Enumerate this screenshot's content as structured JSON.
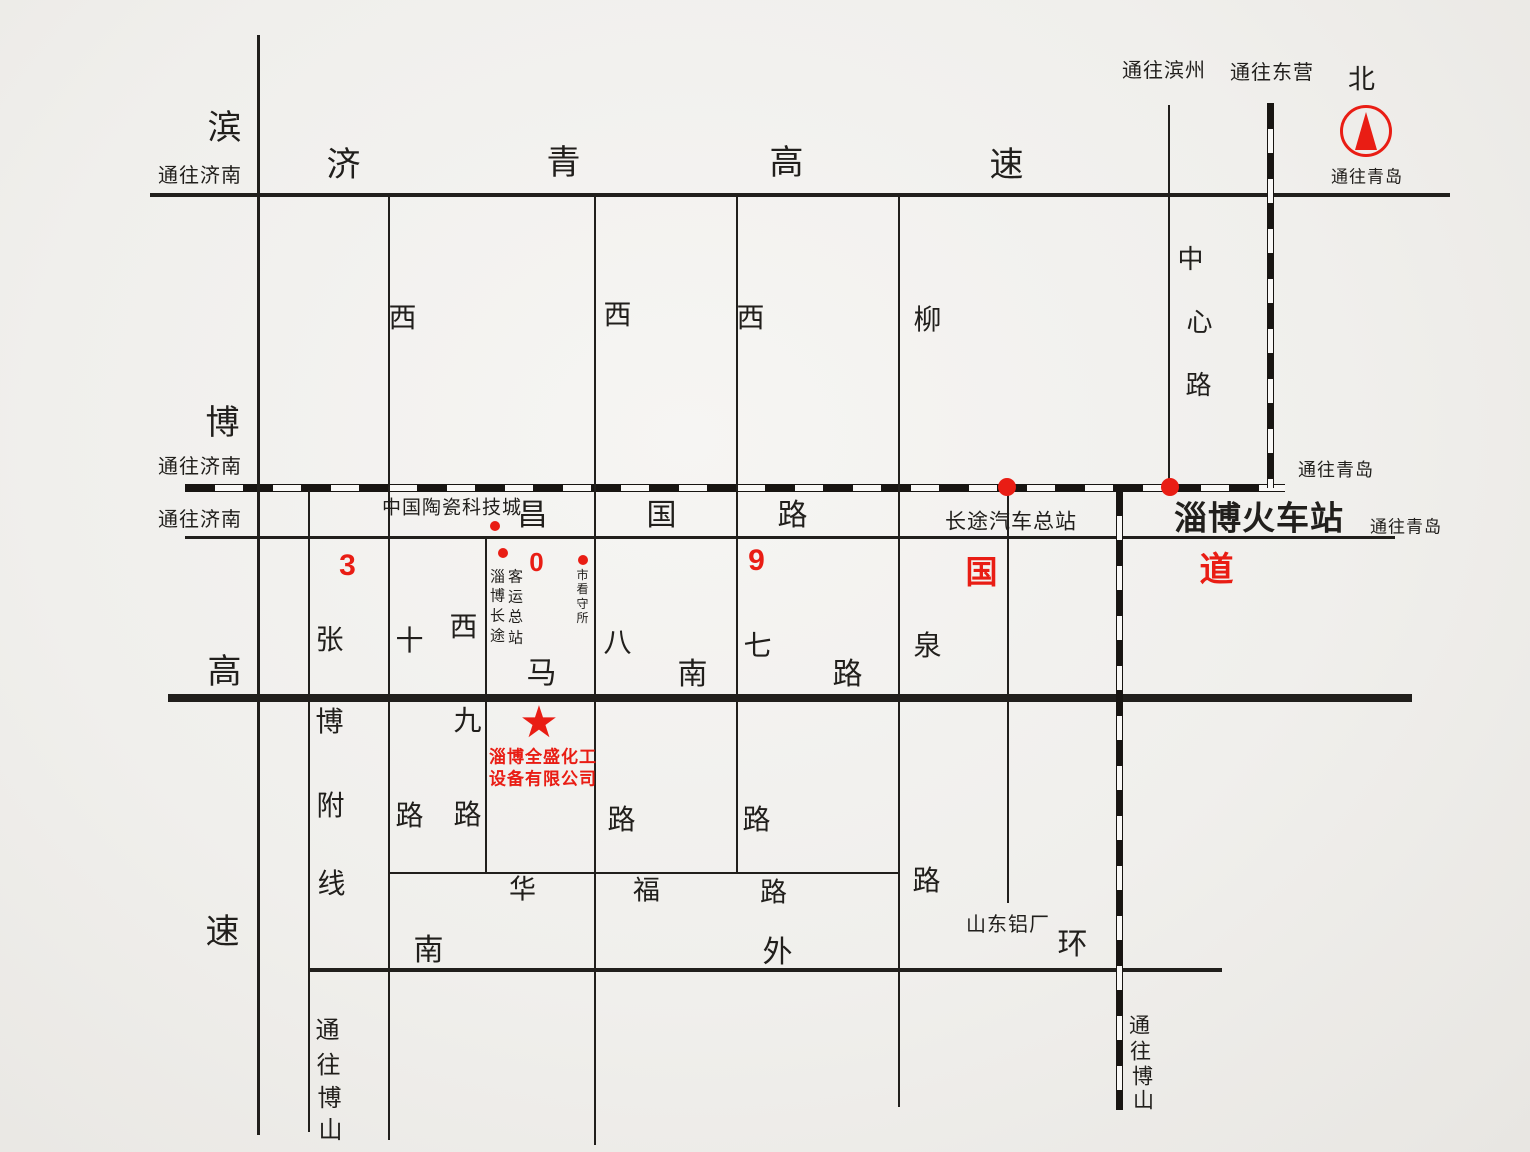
{
  "map": {
    "background_hint": "photographed paper map, light warm grey",
    "ink": "#211f1c",
    "red": "#e91d14",
    "company": {
      "star_marker": "red-star",
      "name_line1": "淄博全盛化工",
      "name_line2": "设备有限公司"
    },
    "roads": [
      {
        "name": "jiqing-expressway",
        "orient": "h",
        "x": 150,
        "y": 193,
        "len": 1300,
        "th": 4
      },
      {
        "name": "railway-main-line",
        "orient": "h",
        "x": 185,
        "y": 484,
        "len": 1100,
        "th": 8,
        "rail": true
      },
      {
        "name": "changguo-road",
        "orient": "h",
        "x": 185,
        "y": 536,
        "len": 1210,
        "th": 3
      },
      {
        "name": "manan-road-thick",
        "orient": "h",
        "x": 168,
        "y": 694,
        "len": 1244,
        "th": 8
      },
      {
        "name": "huafu-road",
        "orient": "h",
        "x": 388,
        "y": 872,
        "len": 511,
        "th": 2
      },
      {
        "name": "south-outer-ring-road",
        "orient": "h",
        "x": 310,
        "y": 968,
        "len": 912,
        "th": 4
      },
      {
        "name": "binbo-expressway",
        "orient": "v",
        "x": 257,
        "y": 35,
        "len": 1100,
        "th": 3
      },
      {
        "name": "zhangbo-branch-line",
        "orient": "v",
        "x": 308,
        "y": 490,
        "len": 642,
        "th": 2
      },
      {
        "name": "xishi-road",
        "orient": "v",
        "x": 388,
        "y": 195,
        "len": 945,
        "th": 2
      },
      {
        "name": "xijiu-road",
        "orient": "v",
        "x": 485,
        "y": 537,
        "len": 336,
        "th": 2
      },
      {
        "name": "xiba-road",
        "orient": "v",
        "x": 594,
        "y": 195,
        "len": 950,
        "th": 2
      },
      {
        "name": "xiqi-road",
        "orient": "v",
        "x": 736,
        "y": 195,
        "len": 678,
        "th": 2
      },
      {
        "name": "liuquan-road",
        "orient": "v",
        "x": 898,
        "y": 195,
        "len": 912,
        "th": 2
      },
      {
        "name": "bus-station-street",
        "orient": "v",
        "x": 1007,
        "y": 488,
        "len": 415,
        "th": 2
      },
      {
        "name": "railway-south-branch",
        "orient": "v",
        "x": 1116,
        "y": 490,
        "len": 620,
        "th": 7,
        "rail": true
      },
      {
        "name": "zhongxin-road",
        "orient": "v",
        "x": 1168,
        "y": 105,
        "len": 383,
        "th": 2
      },
      {
        "name": "railway-north-branch",
        "orient": "v",
        "x": 1267,
        "y": 103,
        "len": 385,
        "th": 7,
        "rail": true
      }
    ],
    "labels": [
      {
        "name": "jiqing-expwy-char-ji",
        "t": "济",
        "x": 344,
        "y": 165,
        "s": 34
      },
      {
        "name": "jiqing-expwy-char-qing",
        "t": "青",
        "x": 564,
        "y": 163,
        "s": 34
      },
      {
        "name": "jiqing-expwy-char-gao",
        "t": "高",
        "x": 787,
        "y": 163,
        "s": 34
      },
      {
        "name": "jiqing-expwy-char-su",
        "t": "速",
        "x": 1007,
        "y": 165,
        "s": 34
      },
      {
        "name": "binbo-expwy-char-bin",
        "t": "滨",
        "x": 225,
        "y": 128,
        "s": 34
      },
      {
        "name": "binbo-expwy-char-bo",
        "t": "博",
        "x": 223,
        "y": 423,
        "s": 34
      },
      {
        "name": "binbo-expwy-char-gao",
        "t": "高",
        "x": 225,
        "y": 672,
        "s": 34
      },
      {
        "name": "binbo-expwy-char-su",
        "t": "速",
        "x": 223,
        "y": 932,
        "s": 34
      },
      {
        "name": "to-jinan-top",
        "t": "通往济南",
        "x": 200,
        "y": 176,
        "s": 20
      },
      {
        "name": "to-jinan-railway",
        "t": "通往济南",
        "x": 200,
        "y": 467,
        "s": 20
      },
      {
        "name": "to-jinan-changguo",
        "t": "通往济南",
        "x": 200,
        "y": 520,
        "s": 20
      },
      {
        "name": "to-binzhou",
        "t": "通往滨州",
        "x": 1164,
        "y": 71,
        "s": 20
      },
      {
        "name": "to-dongying",
        "t": "通往东营",
        "x": 1272,
        "y": 73,
        "s": 20
      },
      {
        "name": "north-char",
        "t": "北",
        "x": 1362,
        "y": 80,
        "s": 27
      },
      {
        "name": "to-qingdao-compass",
        "t": "通往青岛",
        "x": 1367,
        "y": 177,
        "s": 17
      },
      {
        "name": "to-qingdao-railway",
        "t": "通往青岛",
        "x": 1336,
        "y": 470,
        "s": 18
      },
      {
        "name": "to-qingdao-changguo",
        "t": "通往青岛",
        "x": 1406,
        "y": 527,
        "s": 17
      },
      {
        "name": "xishi-road-char-xi",
        "t": "西",
        "x": 403,
        "y": 318,
        "s": 28
      },
      {
        "name": "xiba-road-char-xi",
        "t": "西",
        "x": 618,
        "y": 315,
        "s": 28
      },
      {
        "name": "xiqi-road-char-xi",
        "t": "西",
        "x": 751,
        "y": 318,
        "s": 28
      },
      {
        "name": "liuquan-road-char-liu",
        "t": "柳",
        "x": 928,
        "y": 320,
        "s": 28
      },
      {
        "name": "zhongxin-road-char-zhong",
        "t": "中",
        "x": 1191,
        "y": 259,
        "s": 26
      },
      {
        "name": "zhongxin-road-char-xin",
        "t": "心",
        "x": 1200,
        "y": 322,
        "s": 26
      },
      {
        "name": "zhongxin-road-char-lu",
        "t": "路",
        "x": 1199,
        "y": 385,
        "s": 26
      },
      {
        "name": "changguo-road-char-chang",
        "t": "昌",
        "x": 533,
        "y": 516,
        "s": 30
      },
      {
        "name": "changguo-road-char-guo",
        "t": "国",
        "x": 662,
        "y": 516,
        "s": 30
      },
      {
        "name": "changguo-road-char-lu",
        "t": "路",
        "x": 793,
        "y": 516,
        "s": 30
      },
      {
        "name": "ceramics-city",
        "t": "中国陶瓷科技城",
        "x": 452,
        "y": 508,
        "s": 19
      },
      {
        "name": "longdistance-bus-terminal",
        "t": "长途汽车总站",
        "x": 1011,
        "y": 522,
        "s": 21
      },
      {
        "name": "zibo-railway-station",
        "t": "淄博火车站",
        "x": 1259,
        "y": 518,
        "s": 33,
        "b": true
      },
      {
        "name": "route309-digit-3",
        "t": "3",
        "x": 348,
        "y": 566,
        "s": 30,
        "c": "red",
        "b": true
      },
      {
        "name": "route309-digit-0",
        "t": "0",
        "x": 537,
        "y": 562,
        "s": 26,
        "c": "red",
        "b": true
      },
      {
        "name": "route309-digit-9",
        "t": "9",
        "x": 757,
        "y": 561,
        "s": 30,
        "c": "red",
        "b": true
      },
      {
        "name": "route309-char-guo",
        "t": "国",
        "x": 982,
        "y": 572,
        "s": 32,
        "c": "red",
        "b": true
      },
      {
        "name": "route309-char-dao",
        "t": "道",
        "x": 1217,
        "y": 570,
        "s": 34,
        "c": "red",
        "b": true
      },
      {
        "name": "zibo-coach-col1-zi",
        "t": "淄",
        "x": 498,
        "y": 577,
        "s": 15
      },
      {
        "name": "zibo-coach-col1-bo",
        "t": "博",
        "x": 498,
        "y": 596,
        "s": 15
      },
      {
        "name": "zibo-coach-col1-chang",
        "t": "长",
        "x": 498,
        "y": 616,
        "s": 15
      },
      {
        "name": "zibo-coach-col1-tu",
        "t": "途",
        "x": 498,
        "y": 636,
        "s": 15
      },
      {
        "name": "zibo-coach-col2-ke",
        "t": "客",
        "x": 516,
        "y": 577,
        "s": 15
      },
      {
        "name": "zibo-coach-col2-yun",
        "t": "运",
        "x": 516,
        "y": 597,
        "s": 15
      },
      {
        "name": "zibo-coach-col2-zong",
        "t": "总",
        "x": 516,
        "y": 617,
        "s": 15
      },
      {
        "name": "zibo-coach-col2-zhan",
        "t": "站",
        "x": 516,
        "y": 638,
        "s": 15
      },
      {
        "name": "detention-house-shi",
        "t": "市",
        "x": 583,
        "y": 575,
        "s": 12
      },
      {
        "name": "detention-house-kan",
        "t": "看",
        "x": 583,
        "y": 589,
        "s": 12
      },
      {
        "name": "detention-house-shou",
        "t": "守",
        "x": 583,
        "y": 604,
        "s": 12
      },
      {
        "name": "detention-house-suo",
        "t": "所",
        "x": 583,
        "y": 618,
        "s": 12
      },
      {
        "name": "zhangbo-char-zhang",
        "t": "张",
        "x": 330,
        "y": 640,
        "s": 28
      },
      {
        "name": "xishi-road-char-shi",
        "t": "十",
        "x": 410,
        "y": 641,
        "s": 28
      },
      {
        "name": "xijiu-road-char-xi",
        "t": "西",
        "x": 464,
        "y": 627,
        "s": 28
      },
      {
        "name": "xijiu-road-char-jiu",
        "t": "九",
        "x": 468,
        "y": 721,
        "s": 28
      },
      {
        "name": "xiba-road-char-ba",
        "t": "八",
        "x": 618,
        "y": 643,
        "s": 28
      },
      {
        "name": "xiqi-road-char-qi",
        "t": "七",
        "x": 758,
        "y": 646,
        "s": 28
      },
      {
        "name": "liuquan-road-char-quan",
        "t": "泉",
        "x": 928,
        "y": 646,
        "s": 28
      },
      {
        "name": "manan-road-char-ma",
        "t": "马",
        "x": 542,
        "y": 674,
        "s": 30
      },
      {
        "name": "manan-road-char-nan",
        "t": "南",
        "x": 693,
        "y": 675,
        "s": 30
      },
      {
        "name": "manan-road-char-lu",
        "t": "路",
        "x": 848,
        "y": 675,
        "s": 30
      },
      {
        "name": "zhangbo-char-bo",
        "t": "博",
        "x": 330,
        "y": 722,
        "s": 28
      },
      {
        "name": "zhangbo-char-fu",
        "t": "附",
        "x": 331,
        "y": 806,
        "s": 28
      },
      {
        "name": "zhangbo-char-xian",
        "t": "线",
        "x": 332,
        "y": 884,
        "s": 28
      },
      {
        "name": "xishi-road-char-lu",
        "t": "路",
        "x": 410,
        "y": 816,
        "s": 28
      },
      {
        "name": "xijiu-road-char-lu",
        "t": "路",
        "x": 468,
        "y": 815,
        "s": 28
      },
      {
        "name": "xiba-road-char-lu",
        "t": "路",
        "x": 622,
        "y": 820,
        "s": 28
      },
      {
        "name": "xiqi-road-char-lu",
        "t": "路",
        "x": 757,
        "y": 820,
        "s": 28
      },
      {
        "name": "liuquan-road-char-lu",
        "t": "路",
        "x": 927,
        "y": 881,
        "s": 28
      },
      {
        "name": "huafu-road-char-hua",
        "t": "华",
        "x": 523,
        "y": 890,
        "s": 27
      },
      {
        "name": "huafu-road-char-fu",
        "t": "福",
        "x": 647,
        "y": 891,
        "s": 27
      },
      {
        "name": "huafu-road-char-lu",
        "t": "路",
        "x": 774,
        "y": 893,
        "s": 27
      },
      {
        "name": "ring-road-char-nan",
        "t": "南",
        "x": 429,
        "y": 951,
        "s": 30
      },
      {
        "name": "ring-road-char-wai",
        "t": "外",
        "x": 778,
        "y": 953,
        "s": 30
      },
      {
        "name": "ring-road-char-huan",
        "t": "环",
        "x": 1073,
        "y": 945,
        "s": 30
      },
      {
        "name": "shandong-aluminum-plant",
        "t": "山东铝厂",
        "x": 1008,
        "y": 925,
        "s": 20
      },
      {
        "name": "to-boshan-left-tong",
        "t": "通",
        "x": 328,
        "y": 1031,
        "s": 24
      },
      {
        "name": "to-boshan-left-wang",
        "t": "往",
        "x": 329,
        "y": 1066,
        "s": 24
      },
      {
        "name": "to-boshan-left-bo",
        "t": "博",
        "x": 330,
        "y": 1099,
        "s": 24
      },
      {
        "name": "to-boshan-left-shan",
        "t": "山",
        "x": 331,
        "y": 1131,
        "s": 24
      },
      {
        "name": "to-boshan-right-tong",
        "t": "通",
        "x": 1140,
        "y": 1026,
        "s": 21
      },
      {
        "name": "to-boshan-right-wang",
        "t": "往",
        "x": 1141,
        "y": 1052,
        "s": 21
      },
      {
        "name": "to-boshan-right-bo",
        "t": "博",
        "x": 1143,
        "y": 1077,
        "s": 21
      },
      {
        "name": "to-boshan-right-shan",
        "t": "山",
        "x": 1144,
        "y": 1101,
        "s": 21
      },
      {
        "name": "company-name-line1",
        "t": "淄博全盛化工",
        "x": 543,
        "y": 757,
        "s": 17,
        "c": "red",
        "b": true
      },
      {
        "name": "company-name-line2",
        "t": "设备有限公司",
        "x": 543,
        "y": 779,
        "s": 17,
        "c": "red",
        "b": true
      }
    ],
    "dots": [
      {
        "name": "ceramics-city-dot",
        "x": 495,
        "y": 526,
        "r": 5
      },
      {
        "name": "coach-terminal-dot",
        "x": 503,
        "y": 553,
        "r": 5
      },
      {
        "name": "detention-house-dot",
        "x": 583,
        "y": 560,
        "r": 5
      },
      {
        "name": "bus-terminal-junction-dot",
        "x": 1007,
        "y": 487,
        "r": 9
      },
      {
        "name": "railway-station-junction-dot",
        "x": 1170,
        "y": 487,
        "r": 9
      }
    ],
    "star": {
      "name": "company-location-star",
      "x": 539,
      "y": 723,
      "s": 44,
      "glyph": "★"
    },
    "compass": {
      "name": "north-compass",
      "cx": 1366,
      "cy": 131,
      "r": 26
    }
  }
}
